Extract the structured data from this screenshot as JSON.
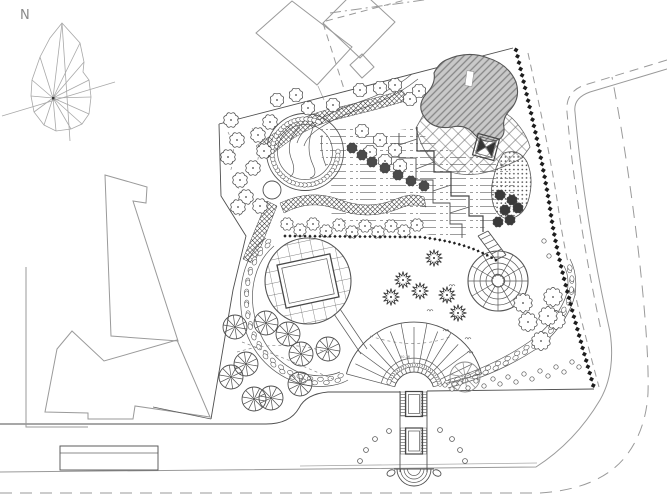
{
  "page": {
    "title": "Landscape park site plan",
    "background": "#ffffff"
  },
  "north": {
    "label": "N"
  },
  "labels": {
    "fan_elevation": "50.76"
  },
  "colors": {
    "line": "#4f4f4f",
    "context": "#9a9a9a",
    "dark": "#1d1d1d",
    "pond_fill": "#c9c9c9",
    "pond_hatch": "#868686"
  },
  "plan": {
    "symbols": [
      {
        "kind": "scallop",
        "r": 6.5,
        "fill": "#ffffff",
        "points": [
          [
            231,
            120
          ],
          [
            270,
            122
          ],
          [
            237,
            140
          ],
          [
            258,
            135
          ],
          [
            264,
            151
          ],
          [
            228,
            157
          ],
          [
            253,
            168
          ],
          [
            240,
            180
          ],
          [
            246,
            197
          ],
          [
            238,
            207
          ],
          [
            260,
            206
          ]
        ]
      },
      {
        "kind": "scallop",
        "r": 6,
        "fill": "#ffffff",
        "points": [
          [
            277,
            100
          ],
          [
            296,
            95
          ],
          [
            308,
            108
          ],
          [
            333,
            105
          ],
          [
            360,
            90
          ],
          [
            380,
            88
          ],
          [
            395,
            85
          ],
          [
            410,
            99
          ],
          [
            419,
            91
          ],
          [
            362,
            131
          ],
          [
            370,
            152
          ],
          [
            380,
            140
          ],
          [
            395,
            150
          ],
          [
            385,
            161
          ],
          [
            400,
            166
          ]
        ]
      },
      {
        "kind": "scallop",
        "r": 4.5,
        "fill": "#4a4a4a",
        "points": [
          [
            352,
            148
          ],
          [
            362,
            155
          ],
          [
            372,
            162
          ],
          [
            385,
            168
          ],
          [
            398,
            175
          ],
          [
            411,
            181
          ],
          [
            424,
            186
          ]
        ]
      },
      {
        "kind": "scallop",
        "r": 5.5,
        "fill": "#ffffff",
        "points": [
          [
            287,
            224
          ],
          [
            300,
            230
          ],
          [
            313,
            224
          ],
          [
            326,
            231
          ],
          [
            339,
            225
          ],
          [
            352,
            232
          ],
          [
            365,
            226
          ],
          [
            378,
            232
          ],
          [
            391,
            226
          ],
          [
            404,
            231
          ],
          [
            417,
            225
          ]
        ]
      },
      {
        "kind": "scallop",
        "r": 8,
        "fill": "#ffffff",
        "points": [
          [
            523,
            303
          ],
          [
            553,
            297
          ],
          [
            528,
            322
          ],
          [
            556,
            320
          ],
          [
            541,
            341
          ],
          [
            548,
            316
          ]
        ]
      },
      {
        "kind": "scallop",
        "r": 4.5,
        "fill": "#3a3a3a",
        "points": [
          [
            500,
            195
          ],
          [
            512,
            200
          ],
          [
            505,
            210
          ],
          [
            518,
            208
          ],
          [
            498,
            222
          ],
          [
            510,
            220
          ]
        ]
      },
      {
        "kind": "conifer",
        "r": 8.5,
        "points": [
          [
            403,
            280
          ],
          [
            391,
            297
          ],
          [
            420,
            291
          ],
          [
            434,
            258
          ],
          [
            447,
            295
          ],
          [
            458,
            313
          ]
        ]
      },
      {
        "kind": "palm",
        "r": 12,
        "points": [
          [
            235,
            327
          ],
          [
            266,
            323
          ],
          [
            288,
            334
          ],
          [
            301,
            354
          ],
          [
            328,
            349
          ],
          [
            231,
            377
          ],
          [
            246,
            364
          ],
          [
            254,
            399
          ],
          [
            271,
            398
          ],
          [
            300,
            384
          ]
        ]
      },
      {
        "kind": "palm",
        "r": 15,
        "color": "#8a8a8a",
        "points": [
          [
            465,
            377
          ]
        ]
      },
      {
        "kind": "shrub",
        "r": 2.2,
        "points": [
          [
            445,
            385
          ],
          [
            452,
            389
          ],
          [
            460,
            383
          ],
          [
            468,
            388
          ],
          [
            476,
            381
          ],
          [
            484,
            386
          ],
          [
            493,
            379
          ],
          [
            500,
            384
          ],
          [
            508,
            377
          ],
          [
            516,
            382
          ],
          [
            524,
            374
          ],
          [
            532,
            379
          ],
          [
            540,
            371
          ],
          [
            548,
            376
          ],
          [
            556,
            367
          ],
          [
            564,
            372
          ],
          [
            572,
            362
          ],
          [
            579,
            367
          ],
          [
            544,
            241
          ],
          [
            549,
            256
          ]
        ]
      },
      {
        "kind": "tuft",
        "points": [
          [
            452,
            285
          ],
          [
            446,
            300
          ],
          [
            456,
            316
          ],
          [
            446,
            330
          ],
          [
            468,
            338
          ],
          [
            438,
            262
          ],
          [
            430,
            310
          ],
          [
            470,
            352
          ]
        ]
      }
    ],
    "pebble_bands": [
      {
        "path": "M270,242 C250,257 242,288 249,320 C255,347 272,367 296,377 C316,384 334,381 344,376",
        "step": 5.5
      },
      {
        "path": "M448,384 Q500,369 539,341 Q564,319 571,294 Q574,276 567,263",
        "step": 5.5
      }
    ],
    "band_edges": [
      "M266,238 C244,255 236,288 243,322 C250,351 269,372 295,382 C317,390 338,386 348,380",
      "M274,246 C256,261 248,289 255,318 C261,343 276,362 298,372 C316,378 331,376 340,372",
      "M448,388 Q502,373 542,345 Q568,322 575,295 Q578,274 570,259",
      "M448,380 Q498,365 536,337 Q560,316 567,293 Q570,277 564,266"
    ],
    "hedges": [
      {
        "path": "M516,50 C528,100 543,160 551,215 C558,262 574,318 594,388",
        "gap": 6.5,
        "size": 3.6,
        "color": "#1d1d1d"
      },
      {
        "path": "M285,236 L420,237 Q455,241 478,251 Q492,257 500,263",
        "gap": 5,
        "size": 2.4,
        "color": "#222222"
      }
    ],
    "dashed_beds": [
      "M228,132 Q238,152 230,172",
      "M252,128 Q263,147 256,166",
      "M237,186 Q247,202 239,216",
      "M237,352 Q285,338 330,353",
      "M370,336 Q415,351 452,336",
      "M242,342 Q290,360 335,380"
    ],
    "bollards": [
      [
        389,
        431
      ],
      [
        375,
        439
      ],
      [
        366,
        450
      ],
      [
        360,
        461
      ],
      [
        440,
        430
      ],
      [
        452,
        439
      ],
      [
        460,
        450
      ],
      [
        465,
        461
      ]
    ],
    "fan": {
      "cx": 414,
      "cy": 392,
      "r_inner": 20,
      "r_outer": 70,
      "deg_start": 15,
      "deg_end": 165,
      "count": 15,
      "pebble_r": 27
    },
    "mound": {
      "cx": 305,
      "cy": 152,
      "r": 33,
      "deg_start": 0,
      "deg_end": 295,
      "step": 7
    },
    "spiral": {
      "cx": 498,
      "cy": 281,
      "radii": [
        6,
        12,
        18,
        24,
        30
      ],
      "spokes": 12,
      "spoke_r0": 5,
      "spoke_r1": 30
    }
  }
}
